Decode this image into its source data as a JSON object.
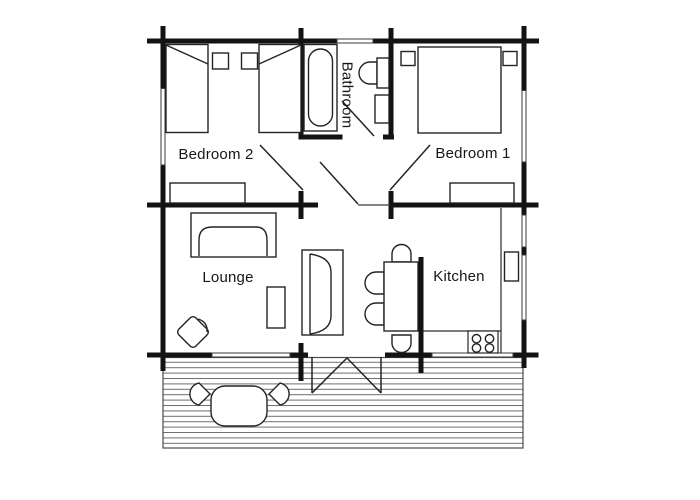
{
  "title": "Cabin floor plan",
  "colors": {
    "background": "#ffffff",
    "wall": "#131313",
    "line": "#242424",
    "deck_line": "#6e6e6e"
  },
  "rooms": [
    {
      "id": "bedroom-2",
      "label": "Bedroom 2"
    },
    {
      "id": "bathroom",
      "label": "Bathroom"
    },
    {
      "id": "bedroom-1",
      "label": "Bedroom 1"
    },
    {
      "id": "lounge",
      "label": "Lounge"
    },
    {
      "id": "kitchen",
      "label": "Kitchen"
    }
  ],
  "furniture": {
    "bedroom_2": [
      "single-bed",
      "single-bed",
      "nightstand",
      "nightstand",
      "dresser"
    ],
    "bathroom": [
      "bathtub",
      "toilet",
      "basin"
    ],
    "bedroom_1": [
      "double-bed",
      "pillow",
      "pillow",
      "dresser"
    ],
    "lounge": [
      "sofa",
      "sofa",
      "coffee-table",
      "armchair"
    ],
    "dining": [
      "dining-table",
      "chair",
      "chair",
      "chair",
      "chair"
    ],
    "kitchen": [
      "counter",
      "sink-unit",
      "stove-4-burner"
    ],
    "deck": [
      "outdoor-table",
      "deck-chair",
      "deck-chair"
    ]
  }
}
